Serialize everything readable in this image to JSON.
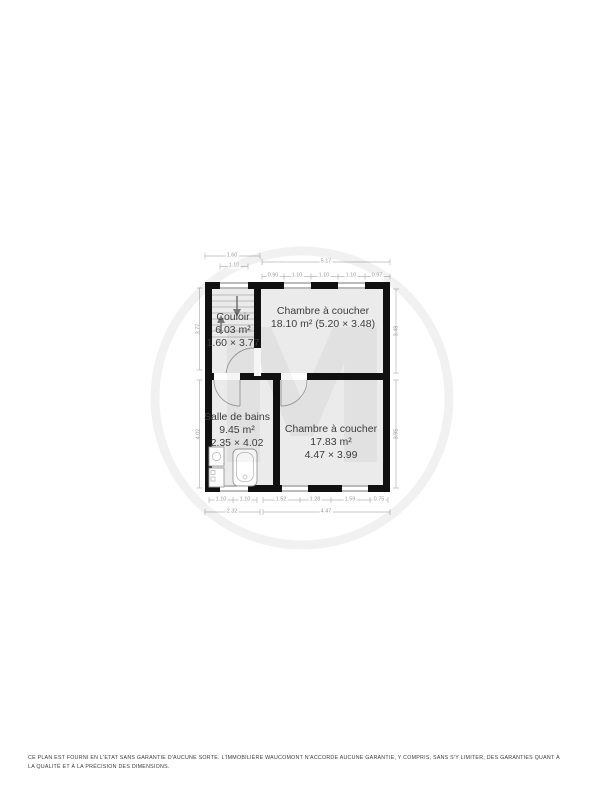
{
  "watermark": {
    "letter": "M"
  },
  "rooms": {
    "couloir": {
      "name": "Couloir",
      "area": "6.03 m²",
      "dims": "1.60 × 3.77"
    },
    "bedroom1": {
      "name": "Chambre à coucher",
      "area_dims": "18.10 m² (5.20 × 3.48)"
    },
    "bathroom": {
      "name": "Salle de bains",
      "area": "9.45 m²",
      "dims": "2.35 × 4.02"
    },
    "bedroom2": {
      "name": "Chambre à coucher",
      "area": "17.83 m²",
      "dims": "4.47 × 3.99"
    }
  },
  "dimensions": {
    "top": {
      "couloir_total": "1.60",
      "couloir_window": "1.10",
      "bedroom_total": "5.17",
      "segments": [
        "0.90",
        "1.10",
        "1.10",
        "1.10",
        "0.97"
      ]
    },
    "bottom": {
      "left_segments": [
        "1.10",
        "1.10"
      ],
      "left_total": "2.32",
      "right_segments": [
        "1.52",
        "1.28",
        "1.59",
        "0.75"
      ],
      "right_total": "4.47"
    },
    "left": {
      "top": "3.77",
      "bottom": "4.02"
    },
    "right": {
      "top": "3.48",
      "bottom": "3.95"
    }
  },
  "footer": {
    "disclaimer": "Ce plan est fourni en l'etat sans garantie d'aucune sorte. L'immobilière Waucomont n'accorde aucune garantie, y compris, sans s'y limiter, des garanties quant à la qualité et à la précision des dimensions."
  },
  "colors": {
    "wall": "#111111",
    "room_fill": "#ebebeb",
    "dim_text": "#9a9a9a"
  }
}
